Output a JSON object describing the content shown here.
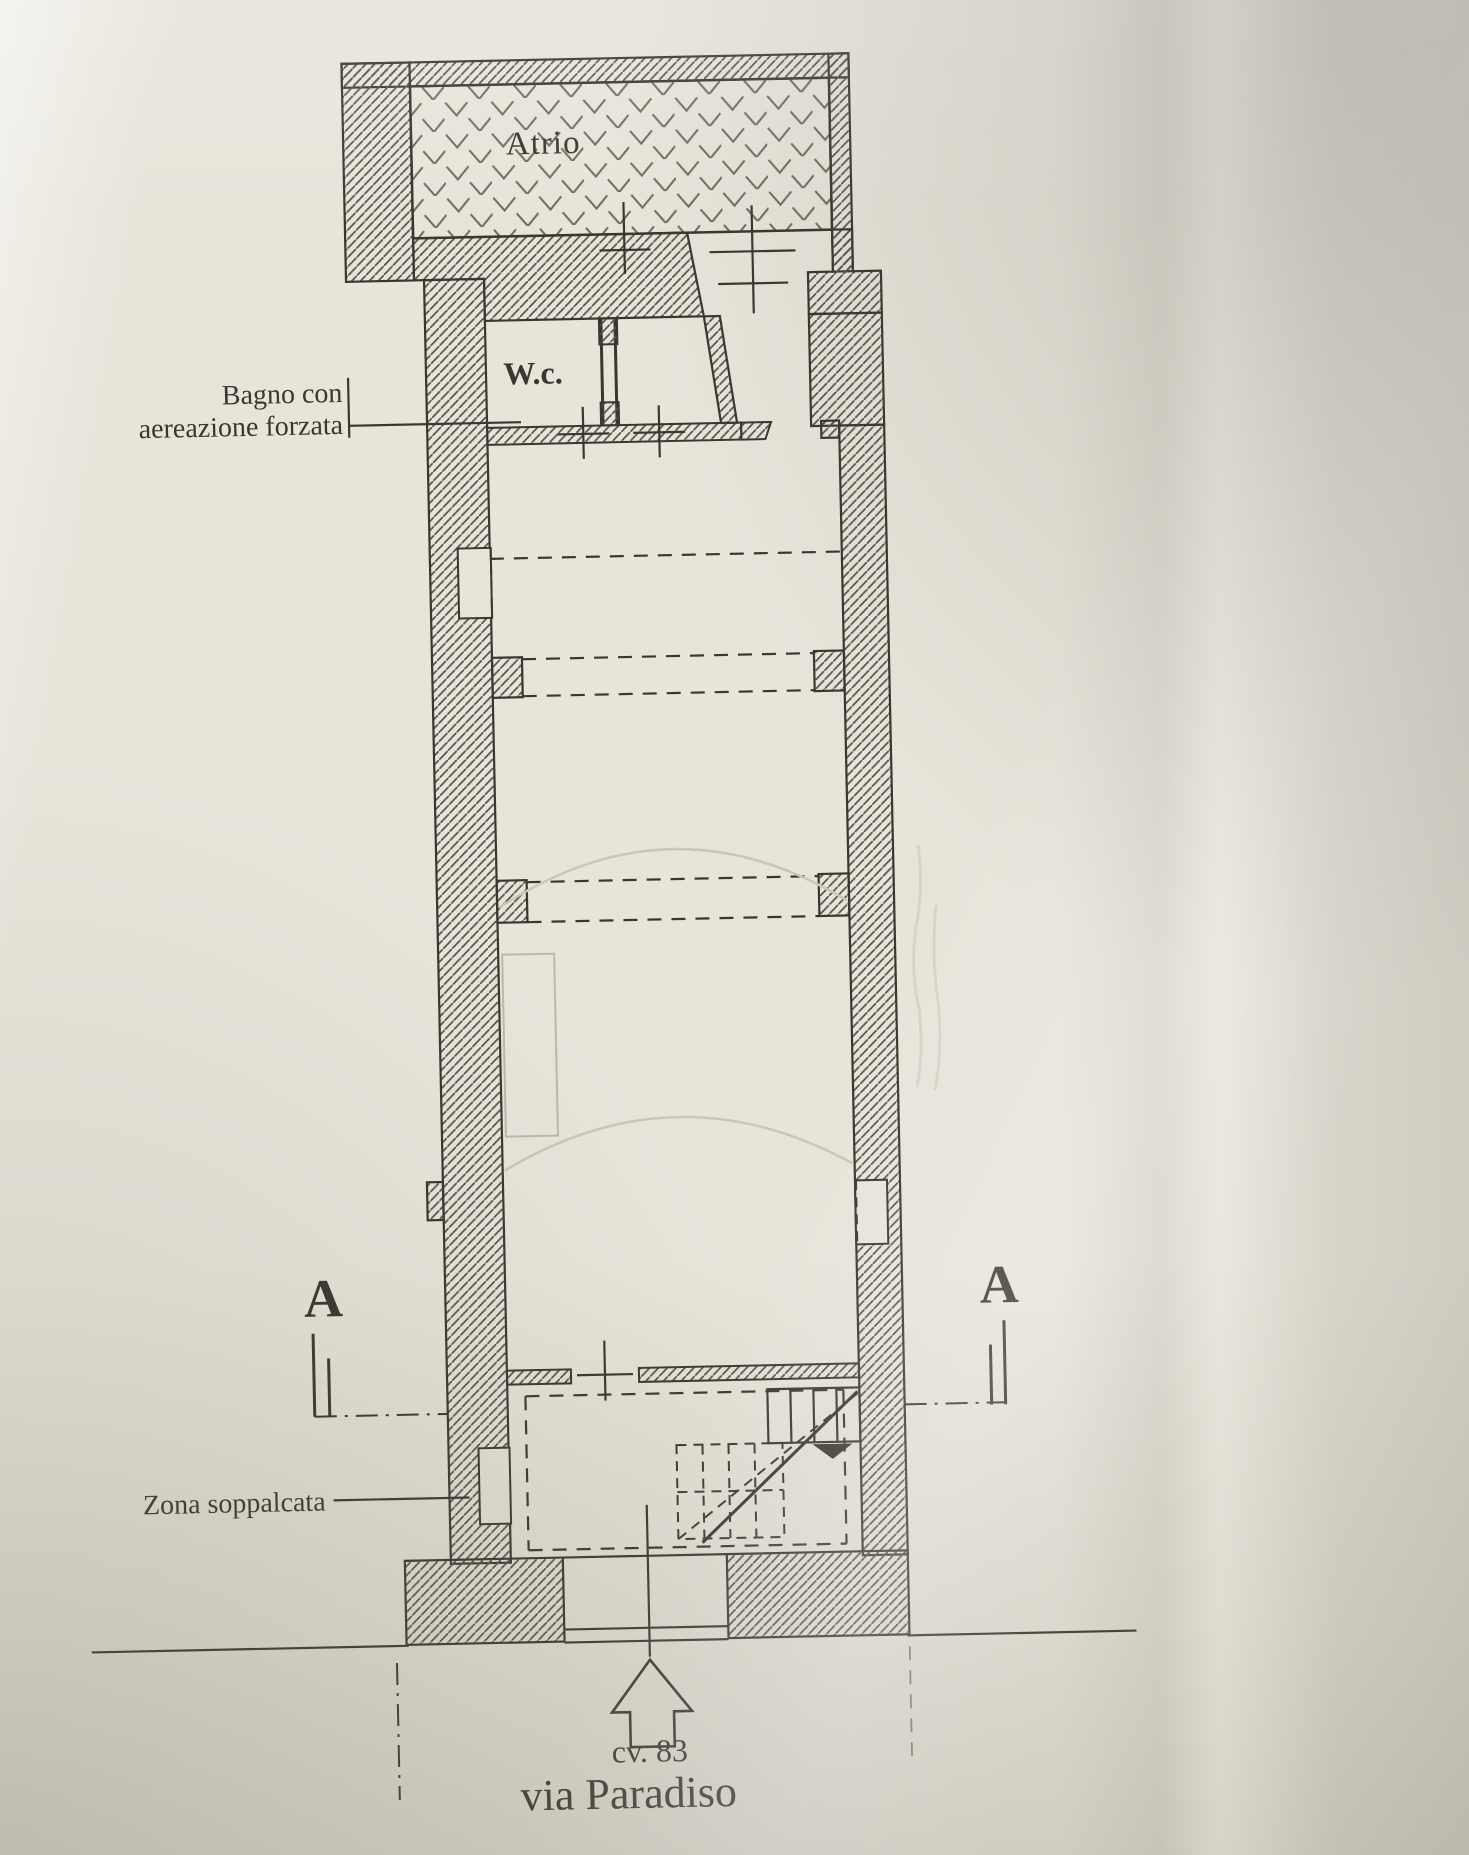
{
  "plan": {
    "atrium_label": "Atrio",
    "wc_label": "W.c.",
    "bathroom_note_line1": "Bagno con",
    "bathroom_note_line2": "aereazione forzata",
    "mezzanine_note": "Zona soppalcata",
    "section_marker_left": "A",
    "section_marker_right": "A",
    "entrance_number": "cv. 83",
    "street_name": "via Paradiso"
  },
  "colors": {
    "paper": "#e7e4da",
    "ink": "#3a372f",
    "wall_hatch": "#57544b",
    "atrium_chevron": "#6f6c5e",
    "faint_construction": "#cbc6b8"
  }
}
